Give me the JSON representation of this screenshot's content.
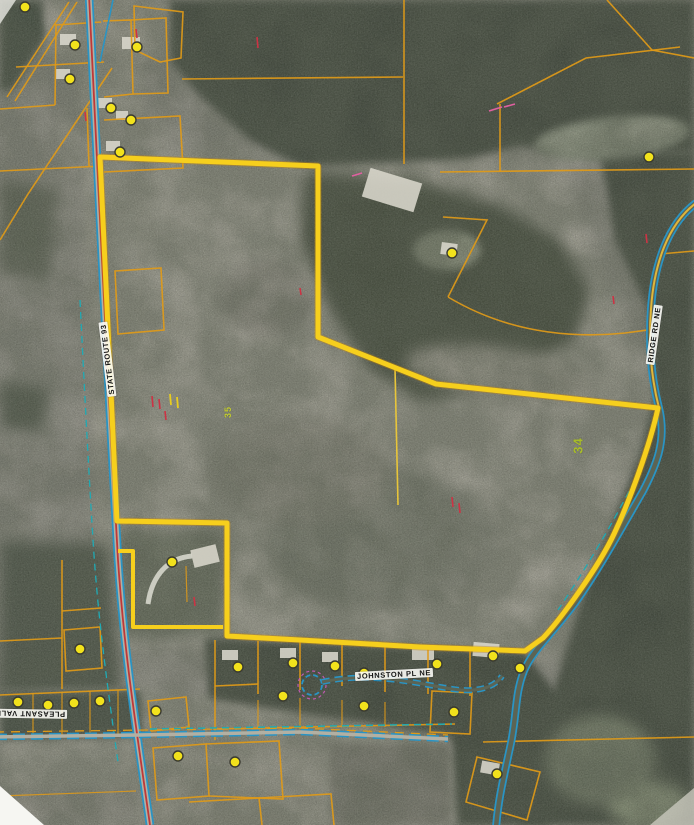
{
  "map": {
    "labels": {
      "route93": "STATE ROUTE 93",
      "johnston": "JOHNSTON PL NE",
      "pleasant_valley": "PLEASANT VALLEY RD",
      "ridge": "RIDGE RD NE",
      "parcel_34": "34",
      "parcel_35": "35"
    },
    "colors": {
      "boundary": "#f6cf1d",
      "boundary_shadow": "#c8860b",
      "parcel_line": "#e09a18",
      "road_casing": "#2a94c4",
      "road_center": "#c03838",
      "utility": "#20aab4",
      "marker_fill": "#f2e21c",
      "marker_stroke": "#3a3a30",
      "annotation_red": "#cc3344",
      "annotation_pink": "#e060a0",
      "label_green": "#a8bc2a"
    },
    "markers": [
      [
        25,
        7
      ],
      [
        75,
        45
      ],
      [
        137,
        47
      ],
      [
        70,
        79
      ],
      [
        111,
        108
      ],
      [
        131,
        120
      ],
      [
        120,
        152
      ],
      [
        452,
        253
      ],
      [
        649,
        157
      ],
      [
        172,
        562
      ],
      [
        80,
        649
      ],
      [
        238,
        667
      ],
      [
        293,
        663
      ],
      [
        335,
        666
      ],
      [
        364,
        673
      ],
      [
        437,
        664
      ],
      [
        493,
        656
      ],
      [
        520,
        668
      ],
      [
        283,
        696
      ],
      [
        364,
        706
      ],
      [
        454,
        712
      ],
      [
        156,
        711
      ],
      [
        18,
        702
      ],
      [
        48,
        705
      ],
      [
        74,
        703
      ],
      [
        100,
        701
      ],
      [
        178,
        756
      ],
      [
        235,
        762
      ],
      [
        497,
        774
      ]
    ]
  }
}
